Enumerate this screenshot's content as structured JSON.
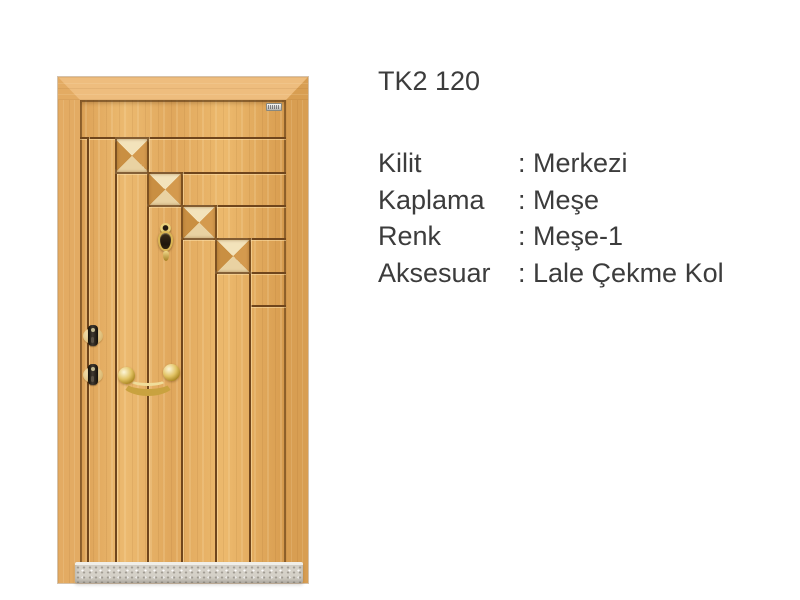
{
  "background_color": "#ffffff",
  "product": {
    "title": "TK2 120",
    "separator": ":",
    "specs": [
      {
        "label": "Kilit",
        "value": "Merkezi"
      },
      {
        "label": "Kaplama",
        "value": "Meşe"
      },
      {
        "label": "Renk",
        "value": "Meşe-1"
      },
      {
        "label": "Aksesuar",
        "value": "Lale Çekme Kol"
      }
    ]
  },
  "door": {
    "parts": [
      "wood-frame",
      "door-leaf",
      "pyramid-panel-1",
      "pyramid-panel-2",
      "pyramid-panel-3",
      "pyramid-panel-4",
      "brand-badge",
      "brass-knocker",
      "upper-lock-cylinder",
      "lower-lock-cylinder",
      "brass-pull-handle",
      "granite-threshold"
    ],
    "colors": {
      "background": "#ffffff",
      "wood_mid": "#e0a75c",
      "frame_top": "#eebd7e",
      "frame_left": "#e3ab63",
      "frame_right": "#d89e52",
      "groove": "#6f451c",
      "pyramid_top": "#f3e3bb",
      "pyramid_bottom": "#e9d2a2",
      "pyramid_left": "#c98f42",
      "pyramid_right": "#d49a4e",
      "brass": "#c9a23f",
      "brass_light": "#f0dd9a",
      "cylinder": "#403931",
      "escutcheon": "#f8ecc6",
      "threshold": "#d5d1c8",
      "threshold_bevel": "#f0eee8",
      "text": "#3c3c3c"
    }
  }
}
